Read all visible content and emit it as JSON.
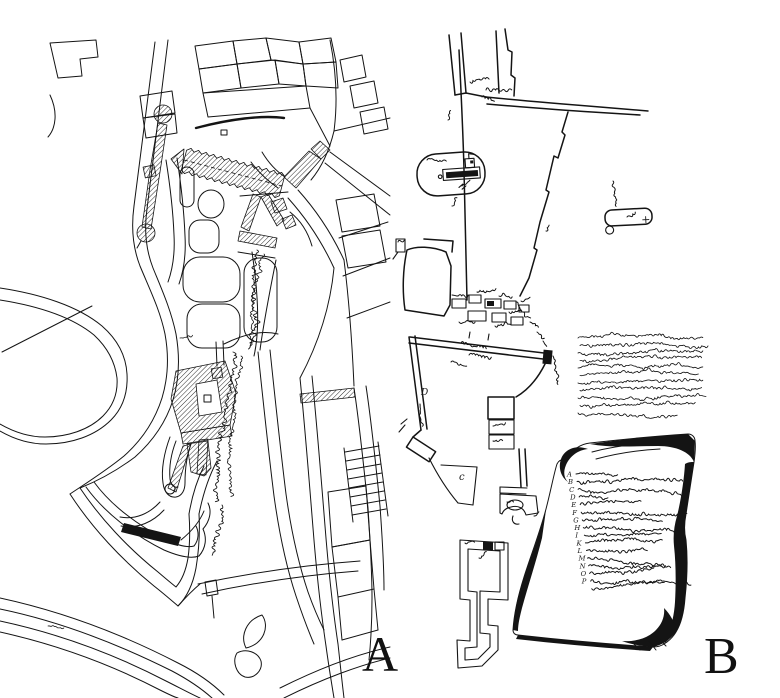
{
  "figure": {
    "bg": "#ffffff",
    "ink": "#141414",
    "panel_count": 2
  },
  "panel_a": {
    "label": "A"
  },
  "panel_b": {
    "label": "B",
    "map_marks": {
      "wall_letter": "D",
      "field_letter": "c",
      "church_cross": "+"
    },
    "paragraph": {
      "line_lengths": [
        125,
        128,
        124,
        120,
        126,
        118,
        124,
        120,
        128,
        115,
        100
      ]
    },
    "scroll_legend": {
      "rows": [
        {
          "letter": "A",
          "len": 42
        },
        {
          "letter": "B",
          "len": 107
        },
        {
          "letter": "C",
          "len": 110
        },
        {
          "letter": "D",
          "len": 30
        },
        {
          "letter": "E",
          "len": 62
        },
        {
          "letter": "F",
          "len": 105
        },
        {
          "letter": "G",
          "len": 80
        },
        {
          "letter": "H",
          "len": 95
        },
        {
          "letter": "I",
          "len": 77
        },
        {
          "letter": "K",
          "len": 78
        },
        {
          "letter": "L",
          "len": 62
        },
        {
          "letter": "M",
          "len": 83
        },
        {
          "letter": "N",
          "len": 77
        },
        {
          "letter": "O",
          "len": 65
        },
        {
          "letter": "P",
          "len": 72
        },
        {
          "letter": "",
          "len": 100
        }
      ]
    }
  }
}
